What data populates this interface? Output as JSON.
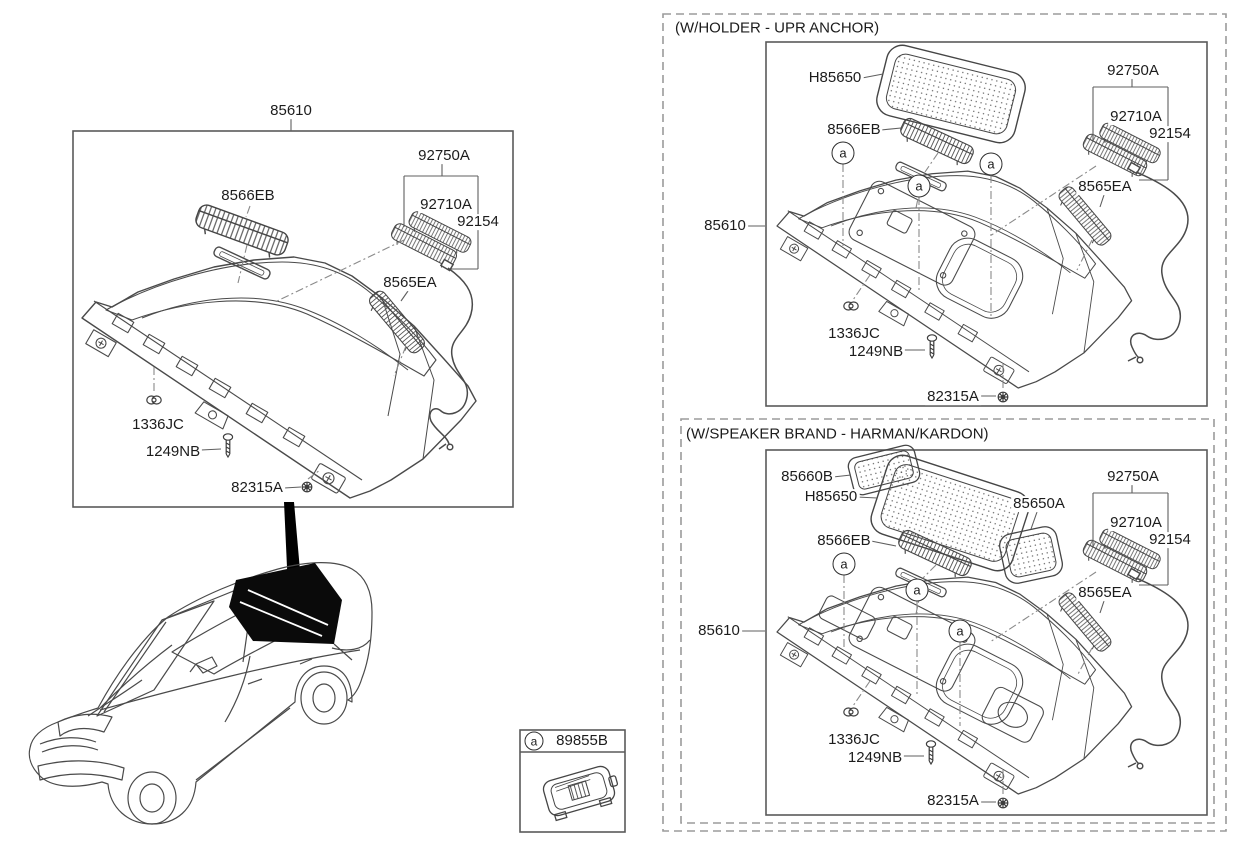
{
  "page": {
    "background": "#ffffff"
  },
  "colors": {
    "line": "#4a4a4a",
    "dash_line": "#8a8a8a",
    "text": "#1c1c1c",
    "highlight_fill": "#000000"
  },
  "main_view": {
    "title": "85610",
    "labels": {
      "grille_slat": "8566EB",
      "lamp_assembly": "92750A",
      "lamp": "92710A",
      "lamp_holder": "92154",
      "side_grille": "8565EA",
      "clip": "1336JC",
      "screw": "1249NB",
      "bolt": "82315A"
    }
  },
  "sections": [
    {
      "header": "(W/HOLDER - UPR ANCHOR)",
      "marker": "a",
      "labels": {
        "tray": "85610",
        "center_grille": "H85650",
        "grille_slat": "8566EB",
        "lamp_assembly": "92750A",
        "lamp": "92710A",
        "lamp_holder": "92154",
        "side_grille": "8565EA",
        "clip": "1336JC",
        "screw": "1249NB",
        "bolt": "82315A"
      }
    },
    {
      "header": "(W/SPEAKER BRAND - HARMAN/KARDON)",
      "marker": "a",
      "labels": {
        "tray": "85610",
        "left_grille": "85660B",
        "center_grille": "H85650",
        "right_grille": "85650A",
        "grille_slat": "8566EB",
        "lamp_assembly": "92750A",
        "lamp": "92710A",
        "lamp_holder": "92154",
        "side_grille": "8565EA",
        "clip": "1336JC",
        "screw": "1249NB",
        "bolt": "82315A"
      }
    }
  ],
  "legend": {
    "marker": "a",
    "part_number": "89855B"
  }
}
